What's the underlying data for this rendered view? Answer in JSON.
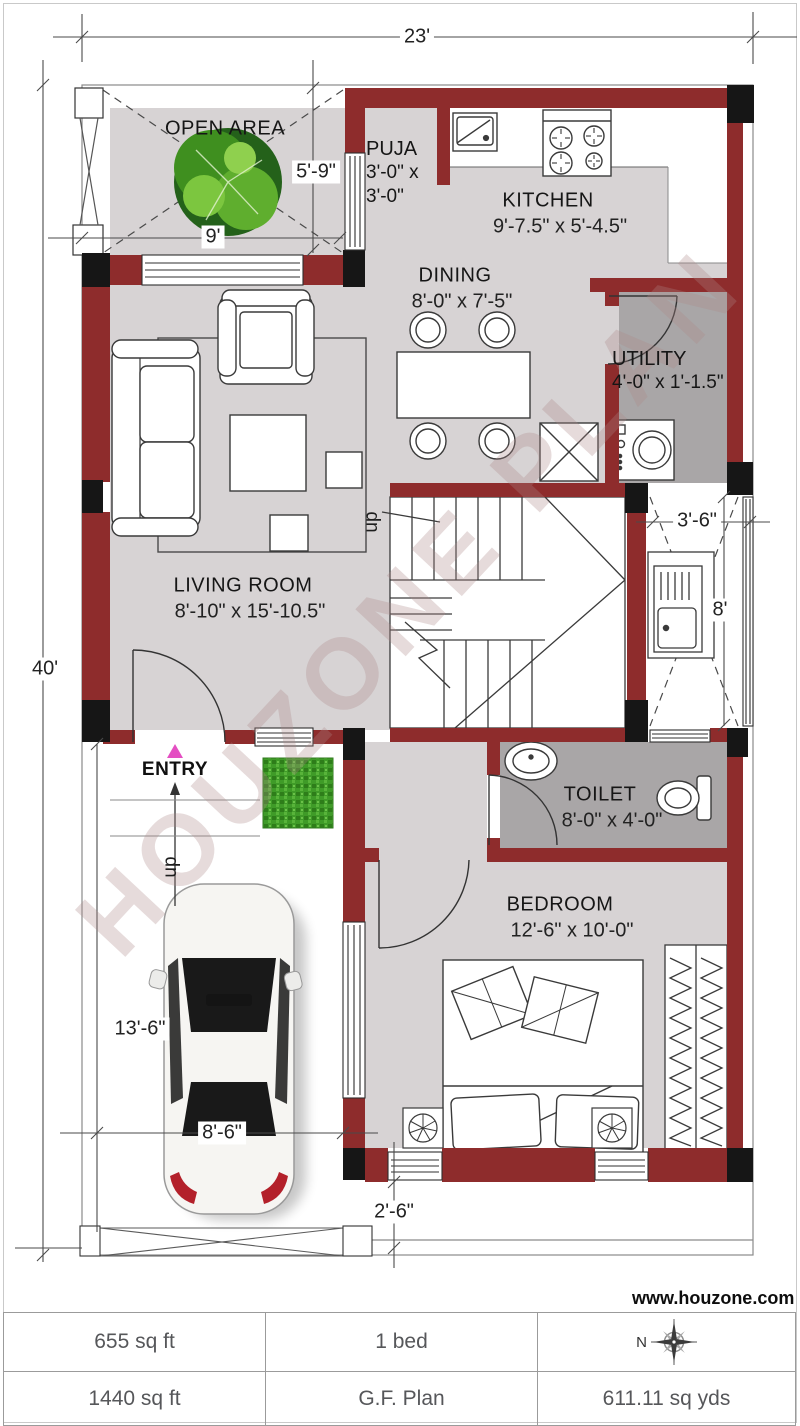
{
  "title": "G.F. Plan floor plan",
  "watermark": "HOUZONE PLAN",
  "rooms": {
    "open_area": {
      "label": "OPEN AREA"
    },
    "puja": {
      "label": "PUJA",
      "size_line1": "3'-0\" x",
      "size_line2": "3'-0\""
    },
    "kitchen": {
      "label": "KITCHEN",
      "size": "9'-7.5\" x 5'-4.5\""
    },
    "dining": {
      "label": "DINING",
      "size": "8'-0\" x 7'-5\""
    },
    "utility": {
      "label": "UTILITY",
      "size": "4'-0\" x 1'-1.5\""
    },
    "living": {
      "label": "LIVING ROOM",
      "size": "8'-10\" x 15'-10.5\""
    },
    "toilet": {
      "label": "TOILET",
      "size": "8'-0\" x 4'-0\""
    },
    "bedroom": {
      "label": "BEDROOM",
      "size": "12'-6\" x 10'-0\""
    },
    "entry": {
      "label": "ENTRY"
    }
  },
  "stairs": {
    "up_label": "up"
  },
  "entry_steps": {
    "up_label": "up"
  },
  "dims": {
    "plot_width": "23'",
    "plot_depth": "40'",
    "open_depth": "5'-9\"",
    "open_width": "9'",
    "shaft_width": "3'-6\"",
    "shaft_depth": "8'",
    "porch_depth": "13'-6\"",
    "porch_width": "8'-6\"",
    "setback": "2'-6\""
  },
  "footer": {
    "website": "www.houzone.com",
    "built_area": "655 sq ft",
    "beds": "1 bed",
    "compass_north": "N",
    "plot_area": "1440  sq ft",
    "plan_name": "G.F. Plan",
    "plot_yards": "611.11 sq yds"
  },
  "colors": {
    "wall": "#8e2c2c",
    "column": "#161616",
    "floor": "#d7d3d4",
    "wet_floor": "#a9a6a7",
    "grass": "#3f9b28",
    "entry_marker": "#e44fc2"
  }
}
